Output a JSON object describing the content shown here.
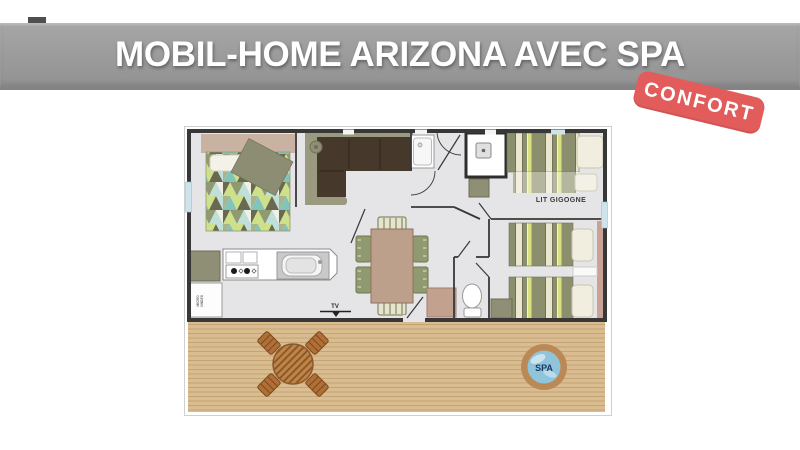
{
  "banner": {
    "title": "MOBIL-HOME ARIZONA AVEC SPA",
    "bg_color": "#9c9c9c",
    "text_color": "#ffffff"
  },
  "badge": {
    "label": "CONFORT",
    "bg_color": "#e25c5c",
    "text_color": "#ffffff"
  },
  "floorplan": {
    "labels": {
      "trundle_bed": "LIT GIGOGNE",
      "tv": "TV",
      "spa": "SPA",
      "appliance_line1": "MICRO",
      "appliance_line2": "ONDES"
    },
    "colors": {
      "wall": "#383838",
      "floor": "#e5e5e7",
      "deck_wood": "#d9bc90",
      "deck_plank_line": "#c2a476",
      "spa_ring": "#bb8955",
      "spa_water": "#8fc4da",
      "spa_text": "#1c3d60",
      "bed_stripe_olive": "#8c8f6e",
      "bed_stripe_cream": "#ebe7cf",
      "bed_stripe_lime": "#d9e07f",
      "duvet_teal": "#82c4b9",
      "duvet_lime": "#cfe08a",
      "sofa_cushion": "#46392c",
      "sofa_base": "#9a9a80",
      "headboard": "#c9b2a2",
      "pink_shelf": "#c9a295",
      "cabinet_olive": "#8f8f75",
      "table_wood": "#bda08c",
      "deck_table": "#c08448",
      "deck_chair": "#b06f36"
    }
  }
}
